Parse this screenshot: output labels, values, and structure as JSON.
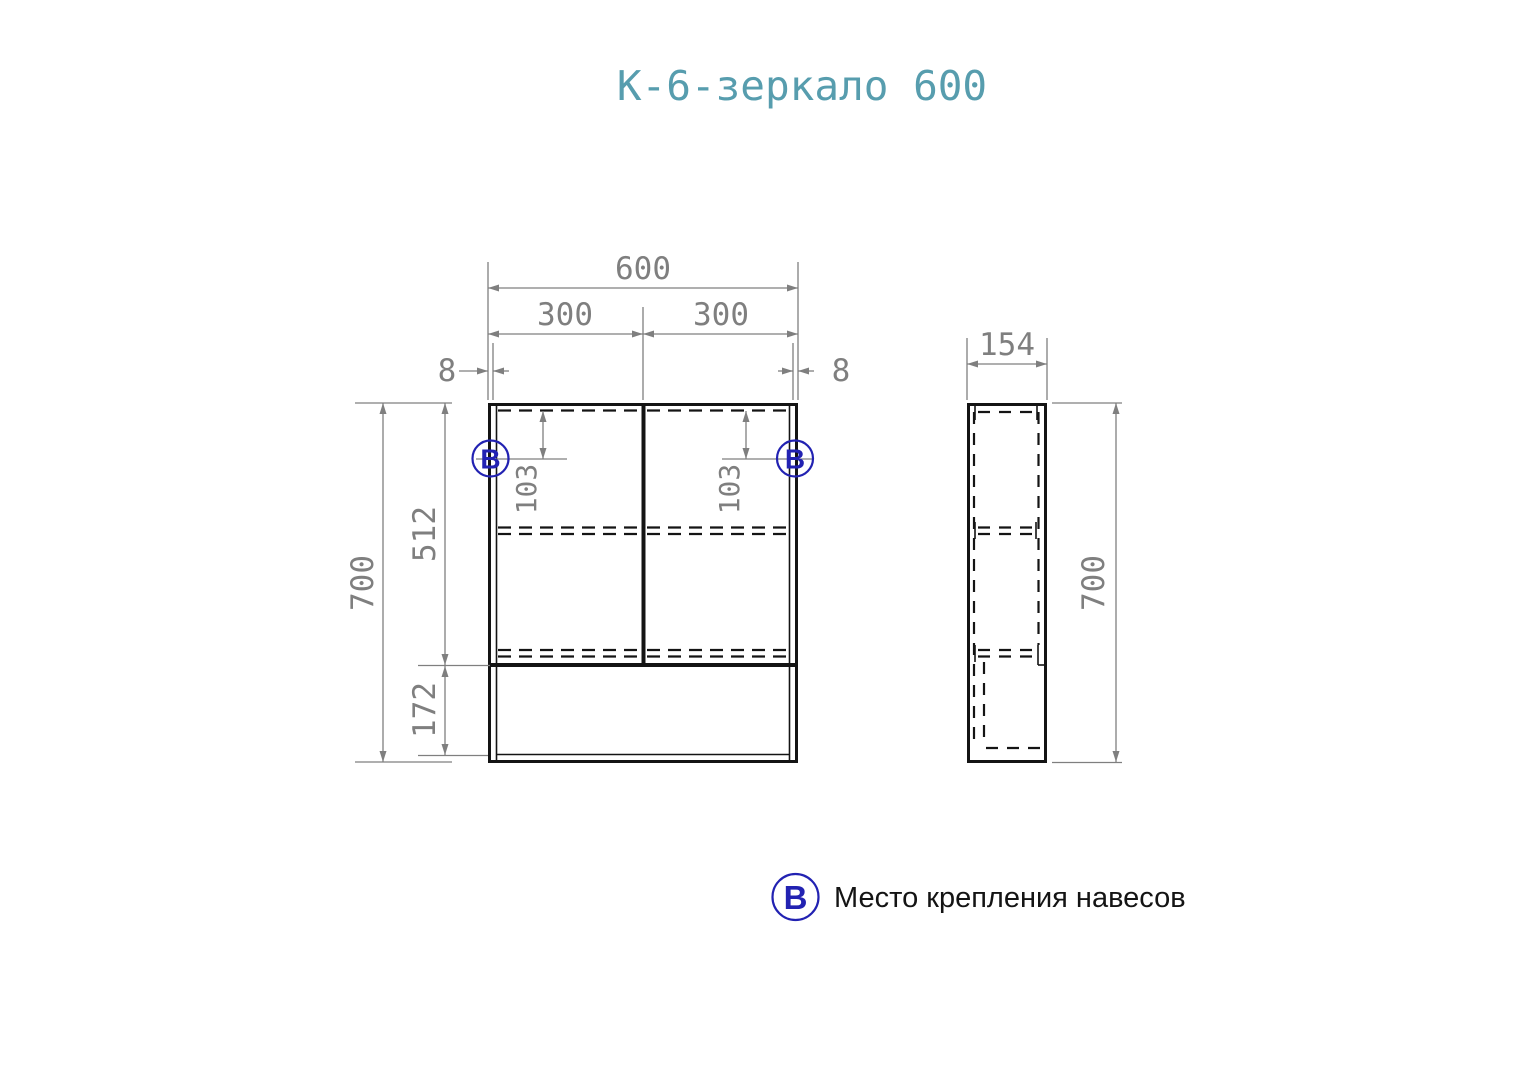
{
  "title": "К-6-зеркало 600",
  "colors": {
    "title_accent": "#579dae",
    "dimension_gray": "#7f7f7f",
    "drawing_black": "#141414",
    "marker_blue": "#2222b2"
  },
  "front_view": {
    "dimensions": {
      "total_width": "600",
      "left_door_width": "300",
      "right_door_width": "300",
      "left_edge_offset": "8",
      "right_edge_offset": "8",
      "total_height": "700",
      "door_section_height": "512",
      "bottom_niche_height": "172",
      "left_hinge_offset": "103",
      "right_hinge_offset": "103"
    },
    "markers": {
      "left": "В",
      "right": "В"
    }
  },
  "side_view": {
    "dimensions": {
      "depth": "154",
      "total_height": "700"
    }
  },
  "legend": {
    "marker": "В",
    "label": "Место крепления навесов"
  }
}
